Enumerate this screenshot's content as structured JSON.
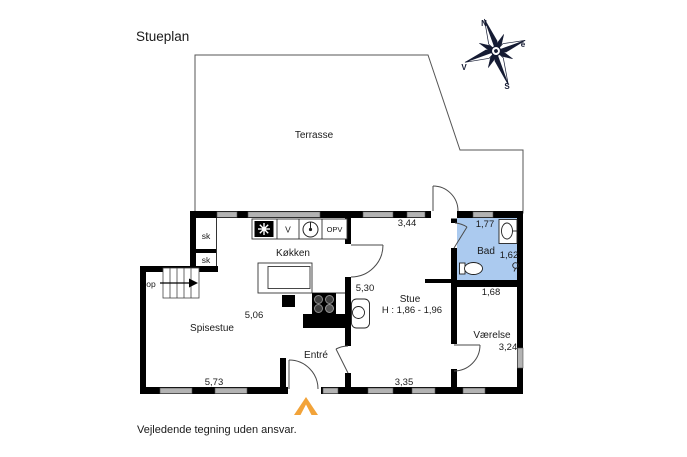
{
  "title": "Stueplan",
  "footer_note": "Vejledende tegning uden ansvar.",
  "compass": {
    "north_label": "N",
    "east_label": "e",
    "south_label": "S",
    "west_label": "V"
  },
  "rooms": {
    "terrasse": {
      "label": "Terrasse"
    },
    "kokken": {
      "label": "Køkken",
      "depth": "5,30"
    },
    "spisestue": {
      "label": "Spisestue",
      "width": "5,73",
      "depth": "5,06"
    },
    "stue": {
      "label": "Stue",
      "ceiling_height": "H : 1,86 - 1,96",
      "width_top": "3,44",
      "width_bottom": "3,35"
    },
    "entre": {
      "label": "Entré"
    },
    "bad": {
      "label": "Bad",
      "width": "1,77",
      "depth": "1,62",
      "width_bottom": "1,68"
    },
    "vaerelse": {
      "label": "Værelse",
      "depth": "3,24"
    },
    "closet_top": {
      "label": "sk"
    },
    "closet_bottom": {
      "label": "sk"
    },
    "stairs": {
      "direction_label": "op"
    }
  },
  "kitchen_appliances": {
    "washing_machine": "V",
    "dishwasher": "OPV"
  },
  "colors": {
    "wall": "#000000",
    "window_glass": "#b3b3b3",
    "bad_fill": "#abcaef",
    "entrance_arrow": "#f2a339",
    "compass": "#151b33"
  }
}
